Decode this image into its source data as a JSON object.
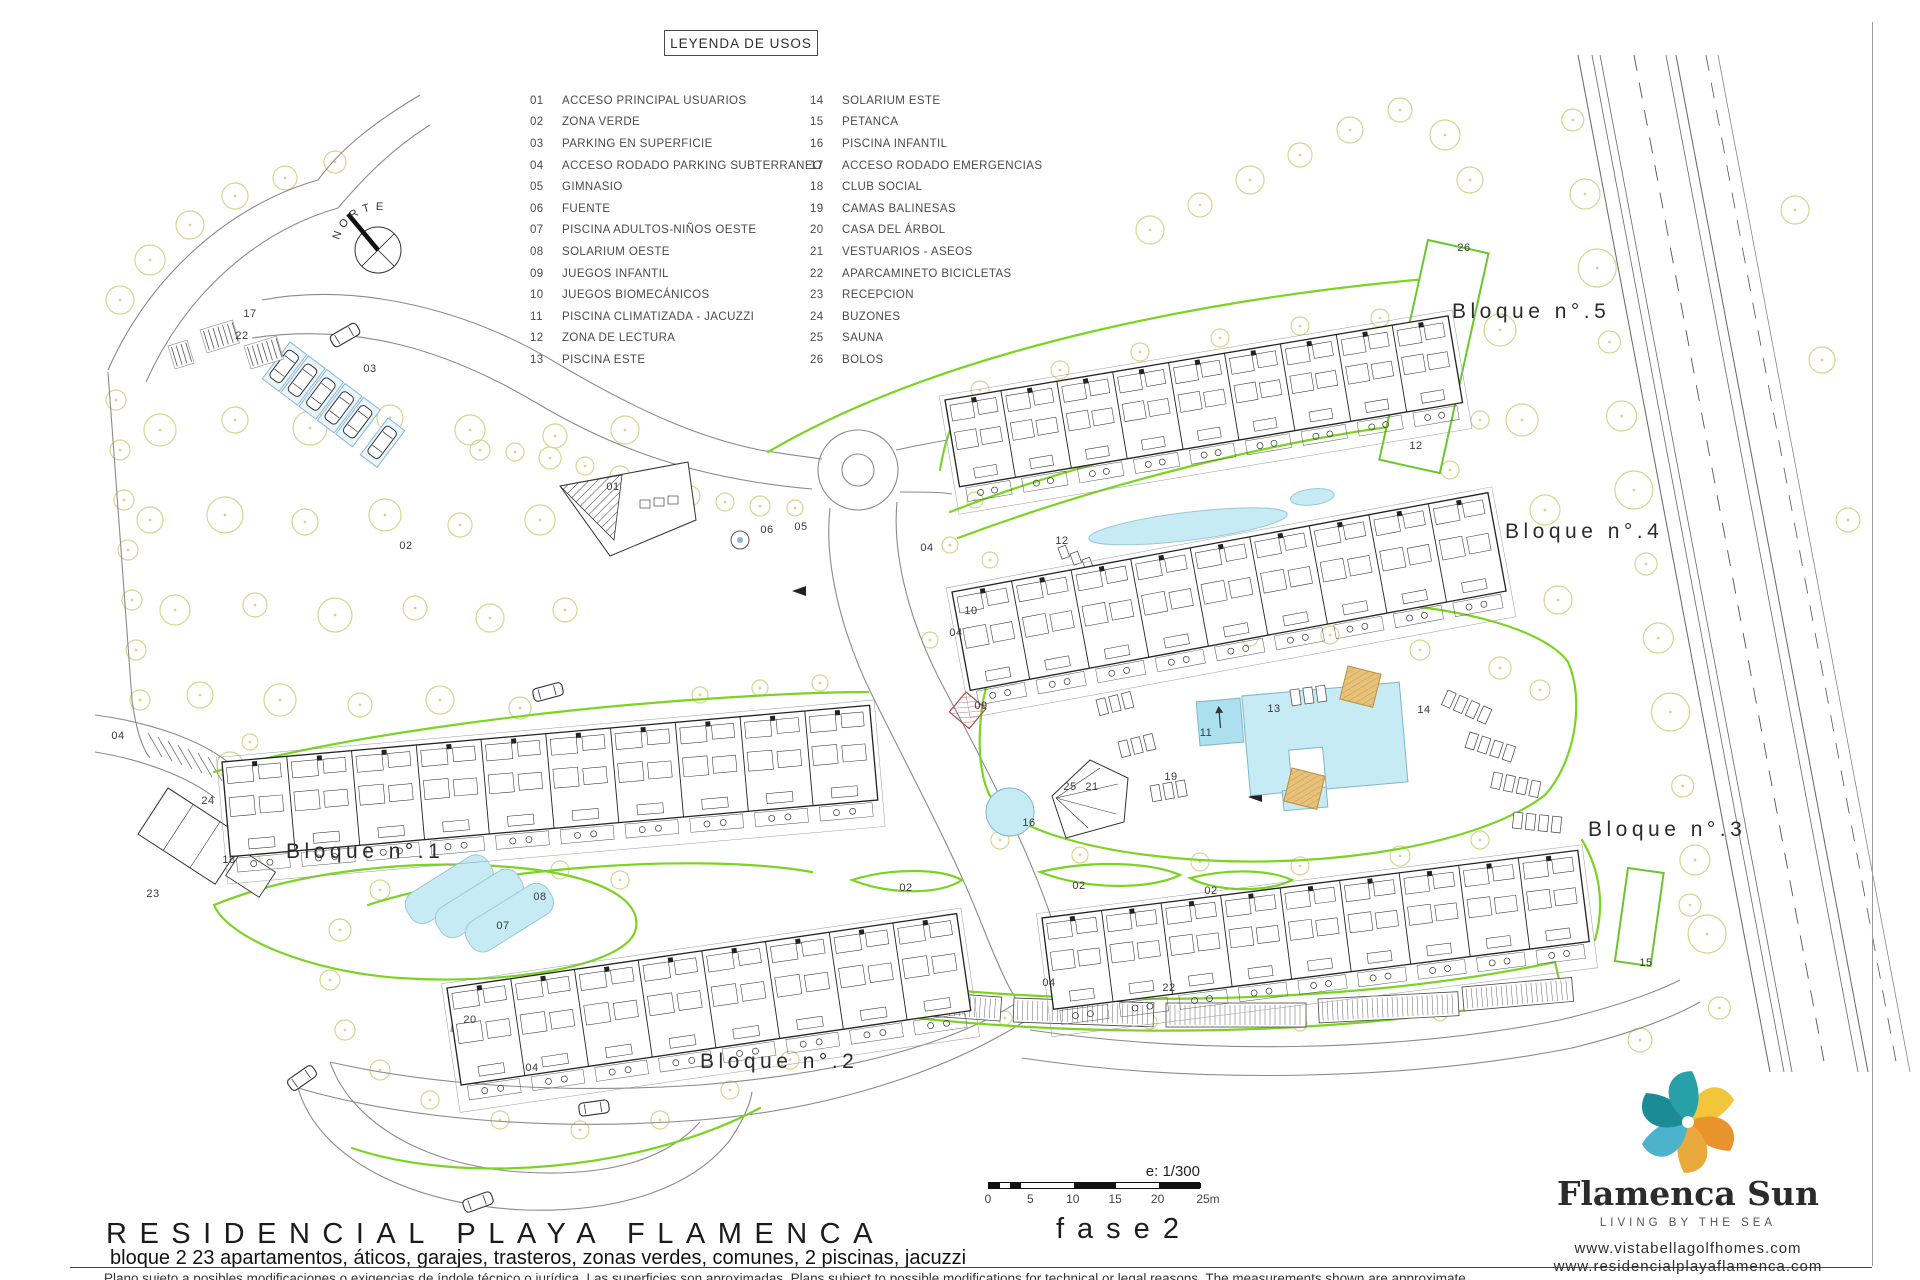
{
  "legend": {
    "title": "LEYENDA DE USOS",
    "left": [
      [
        "01",
        "ACCESO PRINCIPAL USUARIOS"
      ],
      [
        "02",
        "ZONA VERDE"
      ],
      [
        "03",
        "PARKING EN SUPERFICIE"
      ],
      [
        "04",
        "ACCESO RODADO PARKING SUBTERRANEO"
      ],
      [
        "05",
        "GIMNASIO"
      ],
      [
        "06",
        "FUENTE"
      ],
      [
        "07",
        "PISCINA ADULTOS-NIÑOS OESTE"
      ],
      [
        "08",
        "SOLARIUM OESTE"
      ],
      [
        "09",
        "JUEGOS INFANTIL"
      ],
      [
        "10",
        "JUEGOS BIOMECÁNICOS"
      ],
      [
        "11",
        "PISCINA CLIMATIZADA - JACUZZI"
      ],
      [
        "12",
        "ZONA DE LECTURA"
      ],
      [
        "13",
        "PISCINA ESTE"
      ]
    ],
    "right": [
      [
        "14",
        "SOLARIUM ESTE"
      ],
      [
        "15",
        "PETANCA"
      ],
      [
        "16",
        "PISCINA INFANTIL"
      ],
      [
        "17",
        "ACCESO RODADO EMERGENCIAS"
      ],
      [
        "18",
        "CLUB SOCIAL"
      ],
      [
        "19",
        "CAMAS BALINESAS"
      ],
      [
        "20",
        "CASA DEL ÁRBOL"
      ],
      [
        "21",
        "VESTUARIOS - ASEOS"
      ],
      [
        "22",
        "APARCAMINETO BICICLETAS"
      ],
      [
        "23",
        "RECEPCION"
      ],
      [
        "24",
        "BUZONES"
      ],
      [
        "25",
        "SAUNA"
      ],
      [
        "26",
        "BOLOS"
      ]
    ]
  },
  "plan": {
    "north_label": "NORTE",
    "bloques": [
      {
        "label": "Bloque n°.1"
      },
      {
        "label": "Bloque n°.2"
      },
      {
        "label": "Bloque n°.3"
      },
      {
        "label": "Bloque n°.4"
      },
      {
        "label": "Bloque n°.5"
      }
    ],
    "markers": [
      {
        "t": "17",
        "x": 250,
        "y": 314
      },
      {
        "t": "22",
        "x": 242,
        "y": 336
      },
      {
        "t": "03",
        "x": 370,
        "y": 369
      },
      {
        "t": "02",
        "x": 406,
        "y": 546
      },
      {
        "t": "01",
        "x": 613,
        "y": 487
      },
      {
        "t": "06",
        "x": 767,
        "y": 530
      },
      {
        "t": "05",
        "x": 801,
        "y": 527
      },
      {
        "t": "04",
        "x": 927,
        "y": 548
      },
      {
        "t": "10",
        "x": 971,
        "y": 611
      },
      {
        "t": "04",
        "x": 956,
        "y": 633
      },
      {
        "t": "09",
        "x": 981,
        "y": 706
      },
      {
        "t": "24",
        "x": 208,
        "y": 801
      },
      {
        "t": "18",
        "x": 229,
        "y": 860
      },
      {
        "t": "23",
        "x": 153,
        "y": 894
      },
      {
        "t": "04",
        "x": 118,
        "y": 736
      },
      {
        "t": "08",
        "x": 540,
        "y": 897
      },
      {
        "t": "07",
        "x": 503,
        "y": 926
      },
      {
        "t": "20",
        "x": 470,
        "y": 1020
      },
      {
        "t": "04",
        "x": 532,
        "y": 1068
      },
      {
        "t": "02",
        "x": 906,
        "y": 888
      },
      {
        "t": "02",
        "x": 1079,
        "y": 886
      },
      {
        "t": "02",
        "x": 1211,
        "y": 891
      },
      {
        "t": "12",
        "x": 1062,
        "y": 541
      },
      {
        "t": "12",
        "x": 1416,
        "y": 446
      },
      {
        "t": "11",
        "x": 1206,
        "y": 733
      },
      {
        "t": "13",
        "x": 1274,
        "y": 709
      },
      {
        "t": "19",
        "x": 1171,
        "y": 777
      },
      {
        "t": "25",
        "x": 1070,
        "y": 787
      },
      {
        "t": "21",
        "x": 1092,
        "y": 787
      },
      {
        "t": "16",
        "x": 1029,
        "y": 823
      },
      {
        "t": "14",
        "x": 1424,
        "y": 710
      },
      {
        "t": "26",
        "x": 1464,
        "y": 248
      },
      {
        "t": "15",
        "x": 1646,
        "y": 963
      },
      {
        "t": "22",
        "x": 1169,
        "y": 988
      },
      {
        "t": "04",
        "x": 1049,
        "y": 983
      }
    ]
  },
  "scale": {
    "ratio": "e: 1/300",
    "ticks": [
      "0",
      "5",
      "10",
      "15",
      "20",
      "25m"
    ]
  },
  "footer": {
    "title": "RESIDENCIAL PLAYA FLAMENCA",
    "phase": "fase2",
    "subtitle": "bloque 2   23 apartamentos, áticos, garajes, trasteros, zonas verdes, comunes, 2 piscinas, jacuzzi",
    "disclaimer": "Plano sujeto a posibles modificaciones o exigencias de índole técnico o jurídica. Las superficies son aproximadas. Plans subject to possible modifications for technical or legal reasons. The measurements shown are approximate."
  },
  "brand": {
    "name": "Flamenca Sun",
    "tagline": "LIVING BY THE SEA",
    "url1": "www.vistabellagolfhomes.com",
    "url2": "www.residencialplayaflamenca.com"
  },
  "colors": {
    "green": "#7bd322",
    "tree": "#d8d48f",
    "pool": "#c6ebf5",
    "pool_dark": "#ade0ef",
    "tan": "#e8c27a",
    "logo_yellow": "#f2c63b",
    "logo_orange": "#e9932c",
    "logo_orange2": "#e9a93c",
    "logo_teal_light": "#4db3cc",
    "logo_teal_dark": "#1b8b96",
    "logo_teal": "#27a0a8"
  }
}
